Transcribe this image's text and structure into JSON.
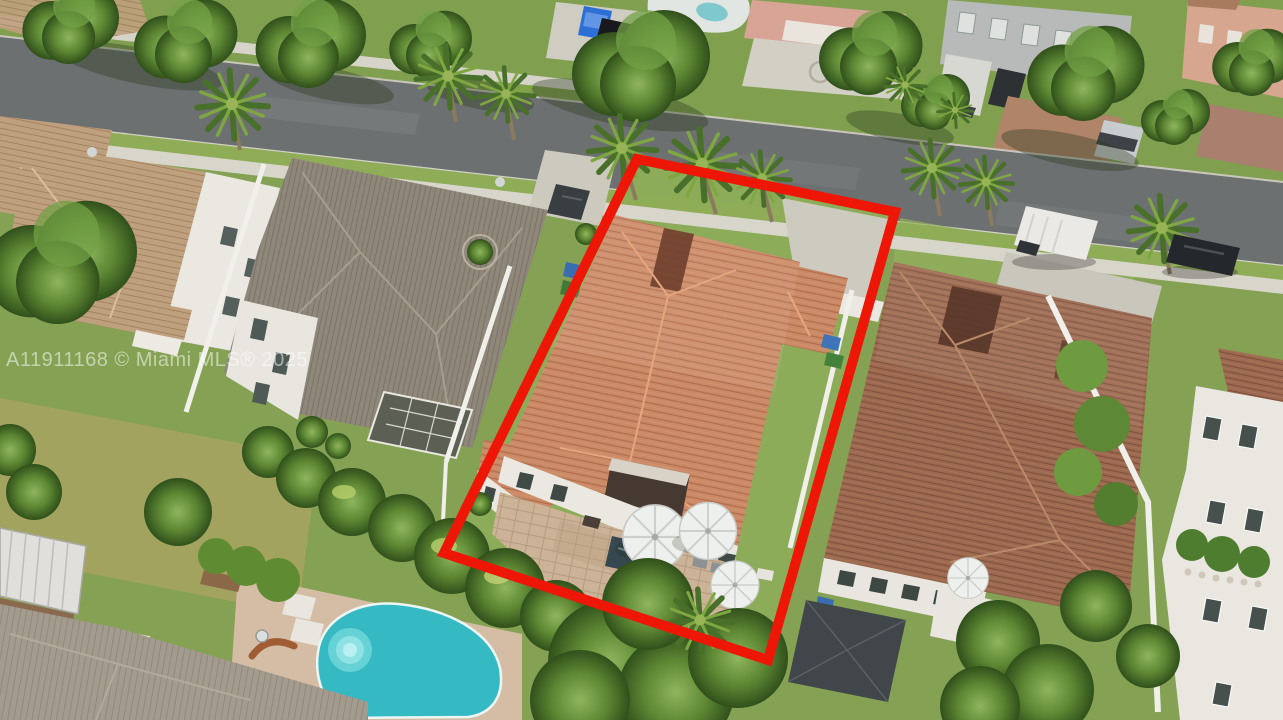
{
  "watermark": {
    "text": "A11911168 © Miami MLS® 2025",
    "color": "rgba(255,255,255,0.52)"
  },
  "annotation": {
    "type": "subject-property-boundary-outline",
    "color": "#ed1607"
  },
  "colors": {
    "street_asphalt": "#6d7071",
    "sidewalk_concrete": "#d8d5ca",
    "lawn_green": "#85a254",
    "subject_roof": "#cb8a67",
    "neighbor_roof_brown": "#9c6950",
    "neighbor_roof_gray": "#8f8779",
    "roof_tan": "#bfa07e",
    "patio_pavers": "#ccb296",
    "pool_water": "#35b9c3",
    "fence_white": "#f0efe9"
  },
  "scene": {
    "description": "Aerial drone photo of a suburban Florida neighborhood; the subject single-family home with terracotta tile roof, paver patio and white umbrellas is outlined in red",
    "elements": [
      "street",
      "sidewalks",
      "subject house",
      "backyard patio with umbrellas",
      "gray-roof neighbor house",
      "brown-roof neighbor house",
      "swimming pool",
      "palm trees",
      "white van",
      "parked cars",
      "white PVC fences"
    ]
  }
}
